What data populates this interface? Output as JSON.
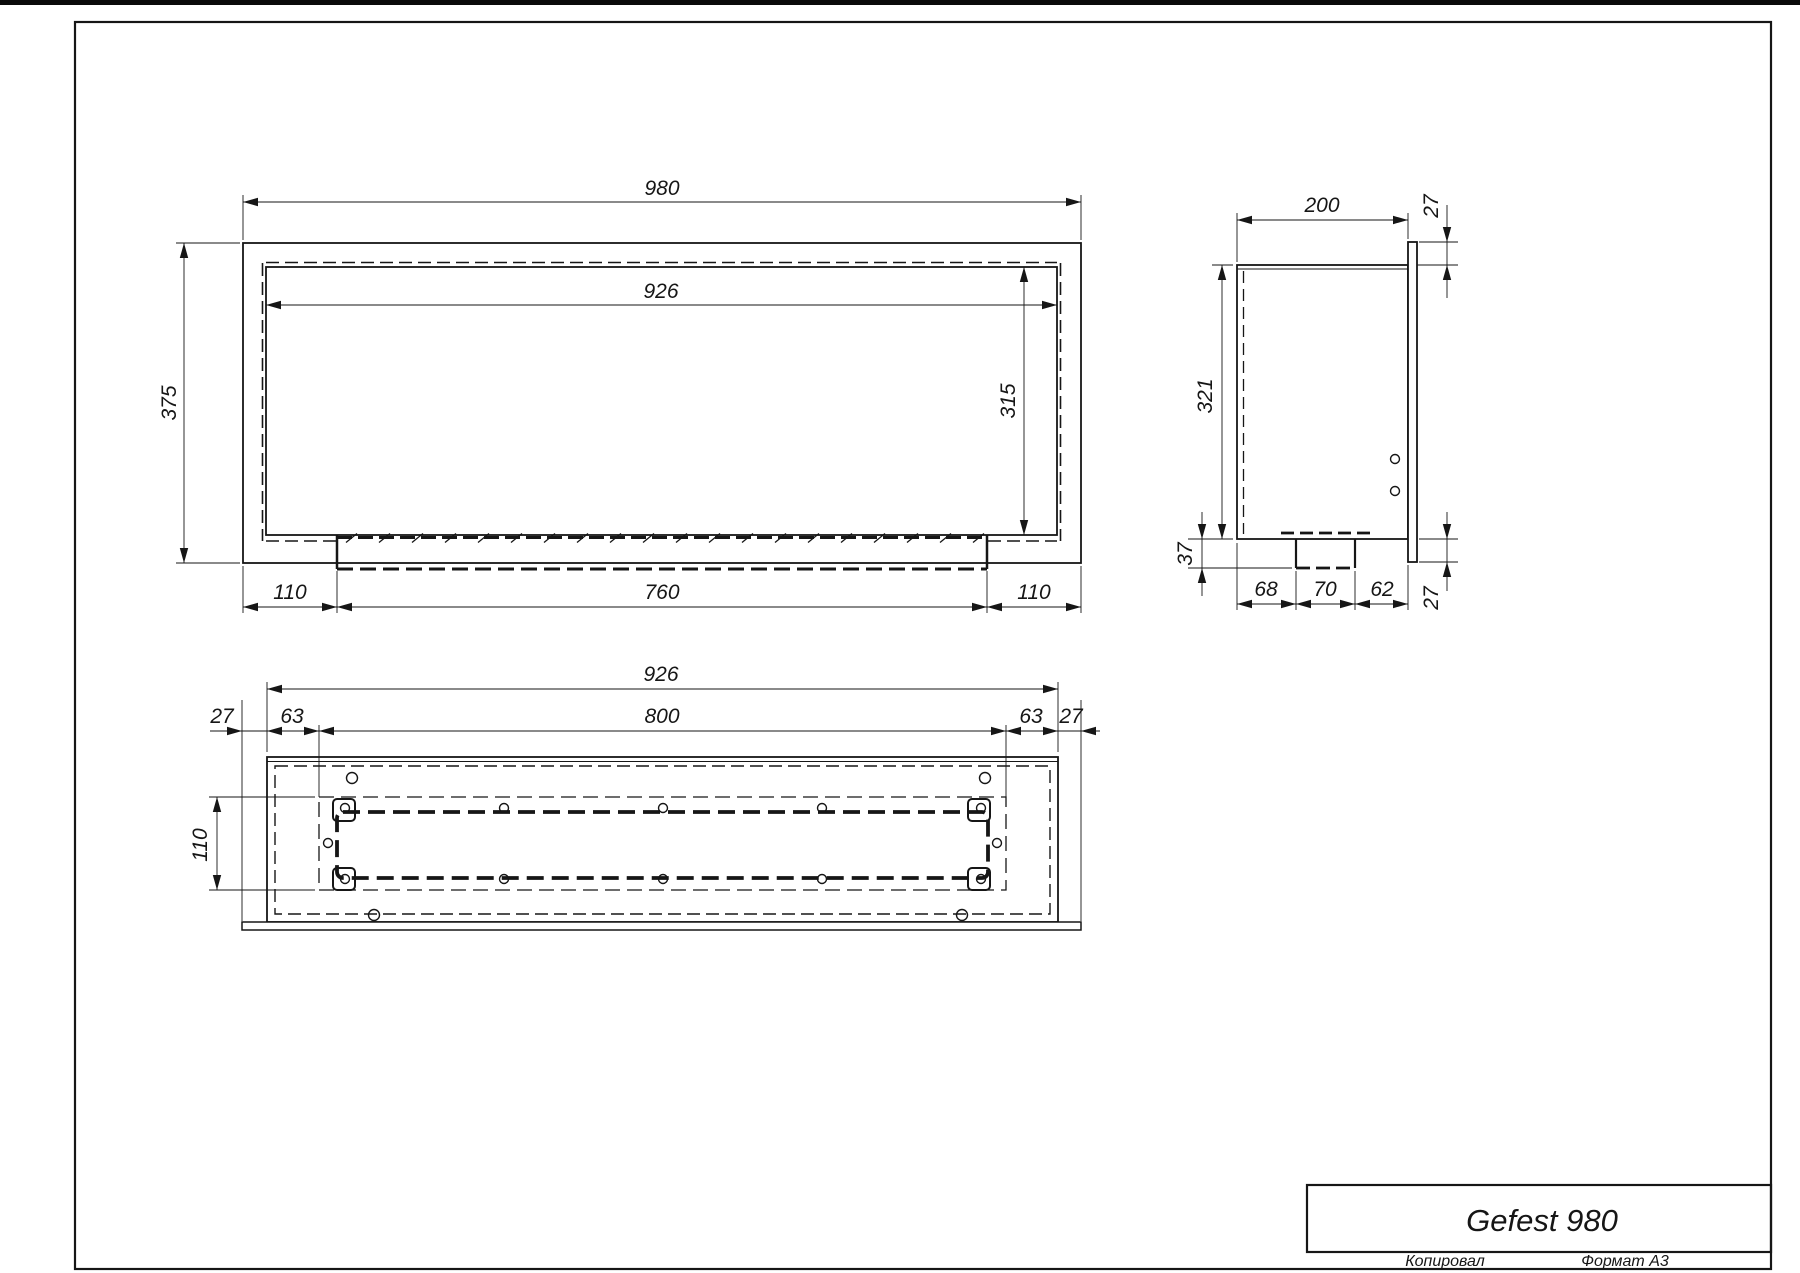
{
  "drawing": {
    "title": "Gefest 980",
    "footer": {
      "copied": "Копировал",
      "format": "Формат А3"
    }
  },
  "front_view": {
    "dim_overall_width": "980",
    "dim_inner_width": "926",
    "dim_overall_height": "375",
    "dim_inner_height": "315",
    "dim_bottom_left": "110",
    "dim_bottom_center": "760",
    "dim_bottom_right": "110"
  },
  "side_view": {
    "dim_depth": "200",
    "dim_flange_top": "27",
    "dim_height": "321",
    "dim_burner_drop": "37",
    "dim_bottom_a": "68",
    "dim_bottom_b": "70",
    "dim_bottom_c": "62",
    "dim_flange_bottom": "27"
  },
  "top_view": {
    "dim_inner_width": "926",
    "dim_opening_width": "800",
    "dim_wall_left": "27",
    "dim_inset_left": "63",
    "dim_inset_right": "63",
    "dim_wall_right": "27",
    "dim_opening_depth": "110"
  }
}
